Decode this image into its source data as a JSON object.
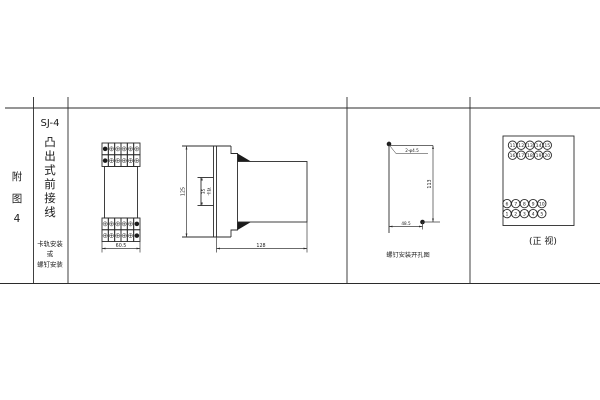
{
  "doc": {
    "appendix_label_chars": [
      "附",
      "图",
      "4"
    ],
    "model": "SJ-4",
    "model_desc_chars": [
      "凸",
      "出",
      "式",
      "前",
      "接",
      "线"
    ],
    "mount_lines": [
      "卡轨安装",
      "或",
      "螺钉安装"
    ]
  },
  "front_view": {
    "width_dim": "60.5",
    "terminal_rows": 2,
    "terminal_cols": 6,
    "dark_cols_top": [
      0
    ],
    "dark_cols_bottom": [
      5
    ]
  },
  "side_view": {
    "height_dim": "125",
    "rail_width_dim": "35",
    "rail_label": "卡轨",
    "depth_dim": "128"
  },
  "drill_view": {
    "holes_label": "2-φ4.5",
    "vertical_spacing_dim": "113",
    "horizontal_spacing_dim": "48.5",
    "caption": "螺钉安装开孔图"
  },
  "terminal_view": {
    "caption": "(正 视)",
    "top_rows": [
      [
        "11",
        "12",
        "13",
        "14",
        "15"
      ],
      [
        "16",
        "17",
        "18",
        "19",
        "20"
      ]
    ],
    "bottom_rows": [
      [
        "6",
        "7",
        "8",
        "9",
        "10"
      ],
      [
        "1",
        "2",
        "3",
        "4",
        "5"
      ]
    ]
  }
}
